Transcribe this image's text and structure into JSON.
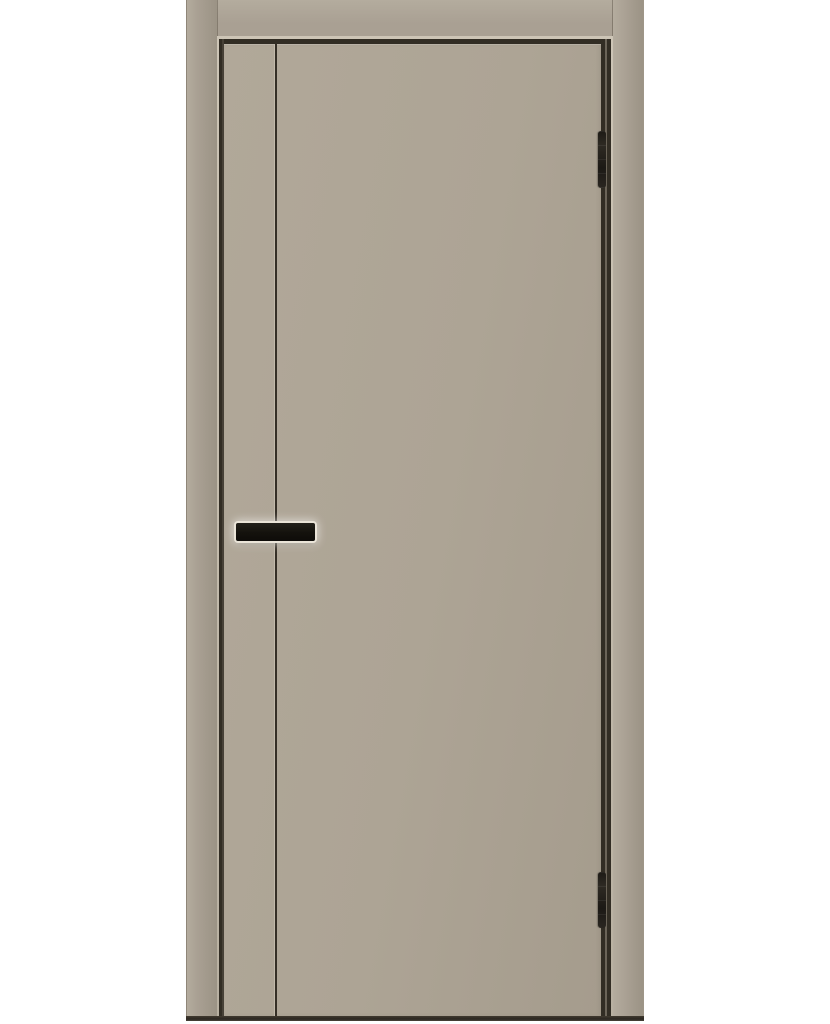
{
  "meta": {
    "type": "product-photo",
    "subject": "Interior flat slab door, front view, in matching frame casing on white studio background",
    "visible_text": "none"
  },
  "door": {
    "style": "flush slab with one full-height vertical decorative groove",
    "finish": "matte warm grey (cashmere / stone)",
    "hardware": "black horizontal bar handle, two dark concealed-style hinges on right edge"
  },
  "parts": {
    "background": "white studio background",
    "casing_left": "left frame casing",
    "casing_right": "right frame casing",
    "casing_top": "top frame casing",
    "sliver_top": "top jamb highlight edge",
    "sliver_left": "left jamb highlight edge",
    "sliver_right": "right jamb highlight edge",
    "reveal_top": "top dark reveal gap",
    "reveal_left": "left dark reveal gap",
    "reveal_right": "right dark reveal gap",
    "leaf": "door leaf",
    "groove": "vertical groove line",
    "handle": "black bar door handle",
    "hinge_top": "upper hinge",
    "hinge_bottom": "lower hinge",
    "bottom_line": "dark floor line at bottom of frame"
  },
  "colors": {
    "bg": "#ffffff",
    "casing": "#a9a093",
    "casing_light": "#b4ac9e",
    "casing_dark": "#9b9385",
    "leaf": "#ada495",
    "leaf_light": "#b1a899",
    "leaf_dark": "#a59c8d",
    "sliver": "#cdc5b6",
    "reveal": "#322d24",
    "reveal_soft": "#6b6458",
    "groove": "#352f26",
    "groove_highlight": "#c2baab",
    "handle": "#16140f",
    "handle_halo": "#eae4d8",
    "hinge": "#26231d",
    "bottom_line": "#2b2721"
  }
}
